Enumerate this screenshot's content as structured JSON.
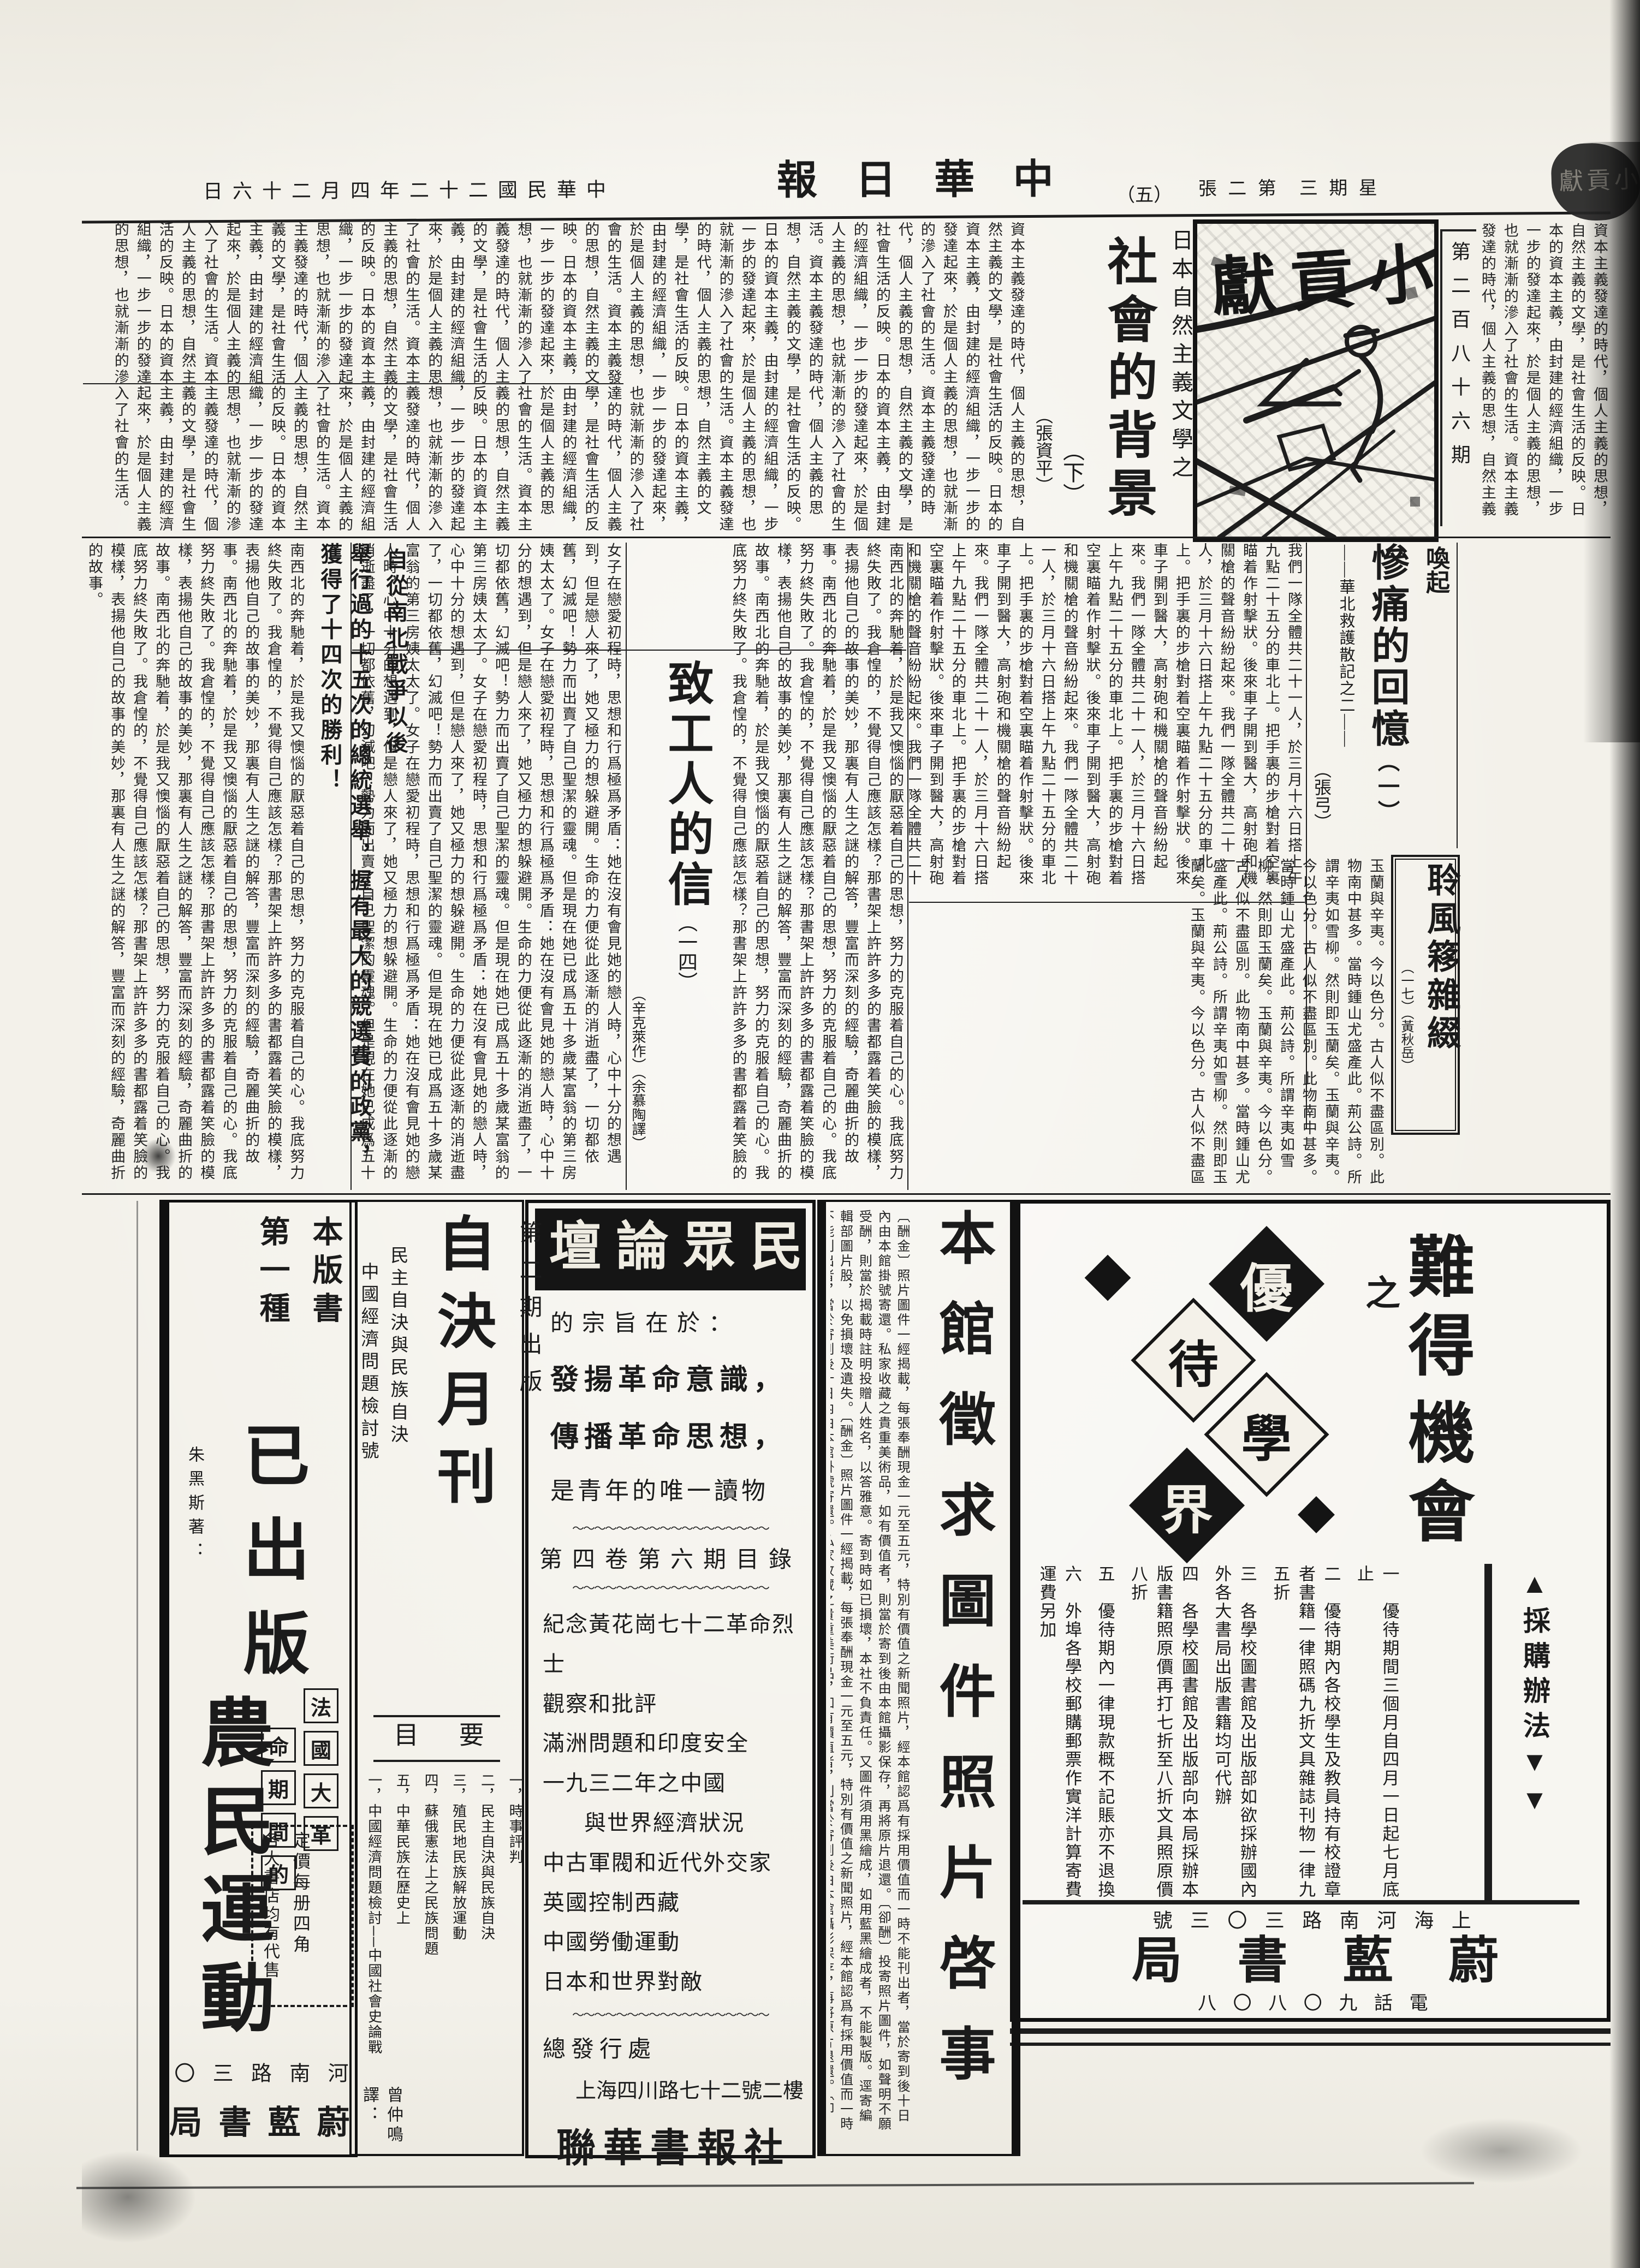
{
  "masthead": {
    "date": "中華民國二十二年四月二十六日",
    "paper": "中華日報",
    "page_no": "（五）",
    "sheet": "第二張",
    "weekday": "星期三",
    "corner": "小貢獻"
  },
  "banner": {
    "title": "小貢獻",
    "issue": "第二百八十六期"
  },
  "articles": {
    "nature": {
      "kicker": "日本自然主義文學之",
      "title": "社會的背景",
      "part": "（下）",
      "author": "（張資平）",
      "body": "資本主義發達的時代，個人主義的思想，自然主義的文學，是社會生活的反映。日本的資本主義，由封建的經濟組織，一步一步的發達起來，於是個人主義的思想，也就漸漸的滲入了社會的生活。"
    },
    "memories": {
      "kicker": "喚起",
      "title": "慘痛的回憶",
      "part": "（一）",
      "subtitle": "——華北救護散記之二——",
      "author": "（張弓）",
      "body": "我們一隊全體共二十一人，於三月十六日搭上午九點二十五分的車北上。把手裏的步槍對着空裏瞄着作射擊狀。後來車子開到醫大，高射砲和機關槍的聲音紛紛起來。"
    },
    "lingfeng": {
      "title": "聆風簃雜綴",
      "part": "（一七）",
      "author": "（黃秋岳）",
      "body": "玉蘭與辛夷。今以色分。古人似不盡區別。此物南中甚多。當時鍾山尤盛產此。荊公詩。所謂辛夷如雪柳。然則即玉蘭矣。"
    },
    "letter": {
      "title": "致工人的信",
      "part": "（一四）",
      "author": "（辛克萊作）",
      "translator": "（余慕陶譯）",
      "emphasis1": "自從南北戰爭以後",
      "emphasis2": "舉行過的十五次的總統選舉，握有最大的競選費的政黨，獲得了十四次的勝利！",
      "body1": "南西北的奔馳着，於是我又懊惱的厭惡着自己的思想，努力的克服着自己的心。我底努力終失敗了。我倉惶的，不覺得自己應該怎樣？那書架上許許多多的書都露着笑臉的模樣，表揚他自己的故事的美妙，那裏有人生之謎的解答，豐富而深刻的經驗，奇麗曲折的故事。",
      "body2": "女子在戀愛初程時，思想和行爲極爲矛盾：她在沒有會見她的戀人時，心中十分的想遇到，但是戀人來了，她又極力的想躲避開。生命的力便從此逐漸的消逝盡了，一切都依舊，幻滅吧！勢力而出賣了自己聖潔的靈魂。但是現在她已成爲五十多歲某富翁的第三房姨太太了。"
    }
  },
  "ads": {
    "weilan": {
      "headline_a": "難得",
      "headline_b": "之",
      "headline_c": "機會",
      "method": "▲採購辦法▼▼",
      "logo": [
        "優",
        "待",
        "學",
        "界"
      ],
      "clauses": [
        "一　優待期間三個月自四月一日起七月底止",
        "二　優待期內各校學生及教員持有校證章者書籍一律照碼九折文具雜誌刊物一律九五折",
        "三　各學校圖書館及出版部如欲採辦國內外各大書局出版書籍均可代辦",
        "四　各學校圖書館及出版部向本局採辦本版書籍照原價再打七折至八折文具照原價八折",
        "五　優待期內一律現款概不記賬亦不退換",
        "六　外埠各學校郵購郵票作實洋計算寄費運費另加"
      ],
      "address": "上海河南路三〇三號",
      "name": "蔚藍書局",
      "phone": "電話九〇八〇八"
    },
    "photo": {
      "title": "本館徵求圖件照片啓事",
      "body": "〔酬金〕照片圖件一經揭載，每張奉酬現金一元至五元，特別有價值之新聞照片，經本館認爲有採用價值而一時不能刊出者，當於寄到後十日內由本館掛號寄還。私家收藏之貴重美術品，如有價值者，則當於寄到後由本館攝影保存，再將原片退還。〔卻酬〕投寄照片圖件，如聲明不願受酬，則當於揭載時註明投贈人姓名，以答雅意。寄到時如已損壞，本社不負責任。又圖件須用黑繪成，如用藍黑繪成者，不能製版。逕寄編輯部圖片股，以免損壞及遺失。"
    },
    "forum": {
      "banner": "民眾論壇",
      "intro0": "的宗旨在於：",
      "intro1": "發揚革命意識，",
      "intro2": "傳播革命思想，",
      "intro3": "是青年的唯一讀物",
      "toc_header": "第四卷第六期目錄",
      "items": [
        "紀念黃花崗七十二革命烈士",
        "觀察和批評",
        "滿洲問題和印度安全",
        "一九三二年之中國",
        "與世界經濟狀況",
        "中古軍閥和近代外交家",
        "英國控制西藏",
        "中國勞働運動",
        "日本和世界對敵"
      ],
      "publisher_label": "總發行處",
      "publisher_addr": "上海四川路七十二號二樓",
      "publisher": "聯華書報社",
      "wavy": "〜〜〜〜〜〜〜〜〜〜〜〜〜〜〜〜〜〜"
    },
    "zijue": {
      "issue": "第二期出版",
      "title": "自決月刊",
      "sub1": "民主自決與民族自決",
      "sub2": "中國經濟問題檢討號",
      "toc_label": "要目",
      "items": [
        "一，時事評判",
        "二，民主自決與民族自決",
        "三，殖民地民族解放運動",
        "四，蘇俄憲法上之民族問題",
        "五，中華民族在歷史上",
        "一，中國經濟問題檢討──中國社會史論戰"
      ],
      "translator_note": "曾仲鳴譯："
    },
    "nongmin": {
      "series1": "本版書",
      "series2": "第一種",
      "status": "已出版",
      "author": "朱黑斯著：",
      "boxed_r": [
        "法",
        "國",
        "大",
        "革"
      ],
      "boxed_l": [
        "命",
        "期",
        "間",
        "的"
      ],
      "title": "農民運動",
      "price": "定價每册四角",
      "sellers": "各大書店均有代售",
      "addr": "河南路三〇三號",
      "pub": "蔚藍書局謹啓"
    }
  }
}
